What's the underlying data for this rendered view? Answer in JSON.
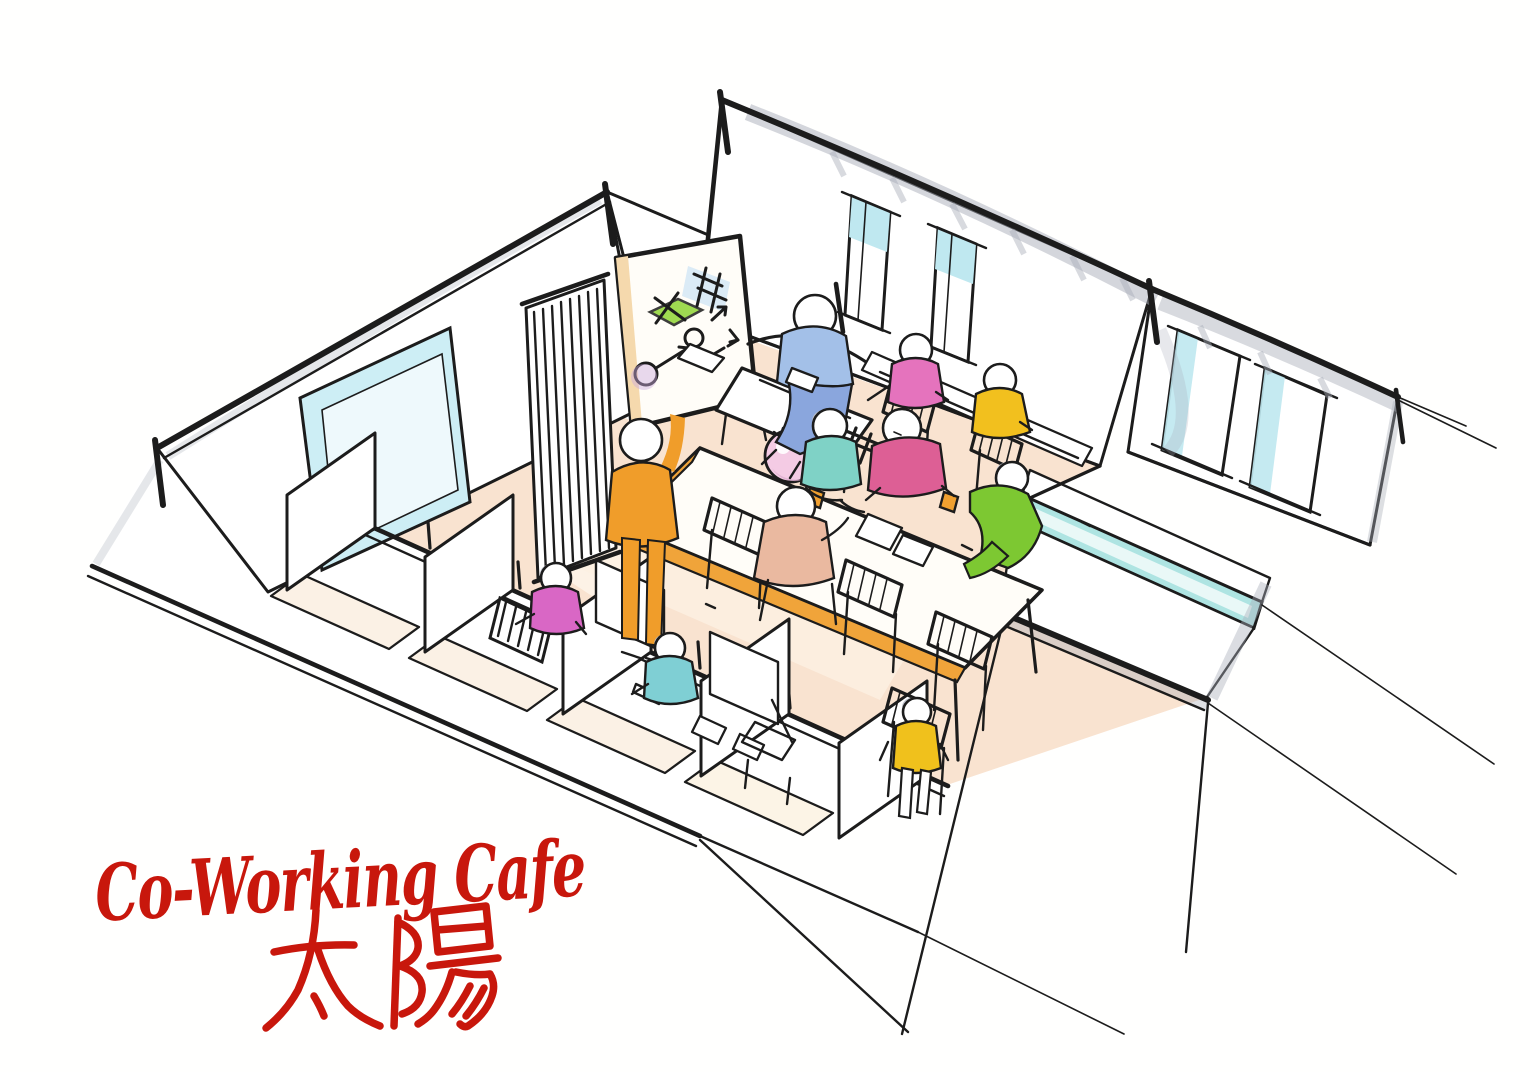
{
  "title": {
    "line1": "Co-Working Cafe",
    "line2": "太陽"
  },
  "palette": {
    "ink": "#1c1c1c",
    "title_red": "#c8170c",
    "floor": "#f9e3d0",
    "floor_light": "#fdf2e6",
    "window": "#cdeef5",
    "window_inner": "#eef9fc",
    "window_sky": "#bfe8f0",
    "window_teal": "#aee4e2",
    "shadow": "#a9aeb9",
    "table_edge": "#f0a43a",
    "board_edge": "#f5d9ad",
    "balloon": "#f4cbe4",
    "balloon_shade": "#d9a8cc",
    "drink": "#f0a030",
    "head_shade": "#bcc0ca",
    "board_green": "#8fd435",
    "board_blue": "#cfe4f5",
    "board_purple": "#cbaade"
  },
  "people": {
    "presenter": {
      "shirt": "#f09d2a"
    },
    "sofa_worker": {
      "shirt": "#a3c0e8",
      "pants": "#8aa6dd"
    },
    "floor_sitter": {
      "shirt": "#7fd2c6"
    },
    "table_leaner": {
      "shirt": "#dd5f95"
    },
    "table_right": {
      "shirt": "#7dc832"
    },
    "table_near": {
      "shirt": "#eab9a0"
    },
    "counter_pink": {
      "shirt": "#e573bd"
    },
    "counter_yellow": {
      "shirt": "#f2c01e"
    },
    "booth_pink": {
      "shirt": "#d967c5"
    },
    "booth_teal": {
      "shirt": "#7fcfd4"
    },
    "walker": {
      "shirt": "#f0c11c"
    }
  }
}
